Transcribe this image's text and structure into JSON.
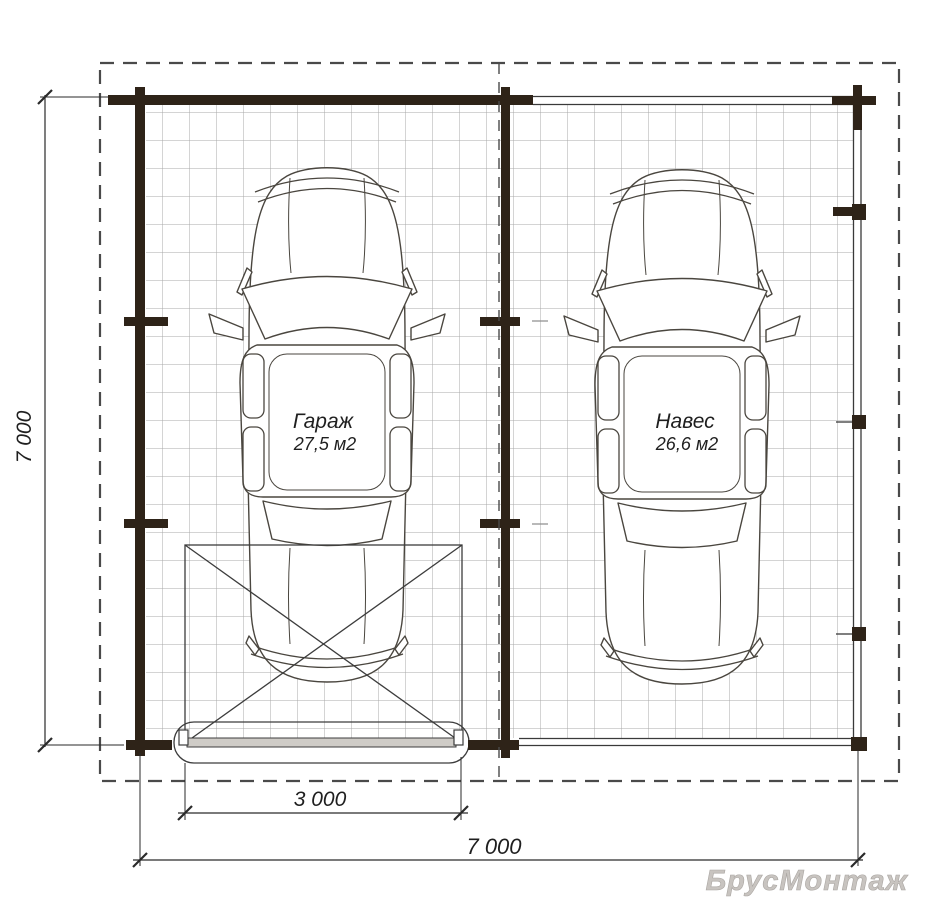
{
  "plan": {
    "title": "garage-floor-plan",
    "rooms": [
      {
        "name": "Гараж",
        "area": "27,5 м2"
      },
      {
        "name": "Навес",
        "area": "26,6 м2"
      }
    ],
    "dimensions": {
      "left_height": "7 000",
      "door_width": "3 000",
      "total_width": "7 000"
    },
    "watermark": "БрусМонтаж"
  },
  "colors": {
    "wall": "#2e2318",
    "line": "#3a3a3a",
    "grid": "#a8a8a8",
    "dim": "#2a2a2a",
    "outline": "#4a4a4a",
    "car": "#4a463f",
    "text": "#1f1f1f",
    "watermark": "#c8c4c0"
  }
}
